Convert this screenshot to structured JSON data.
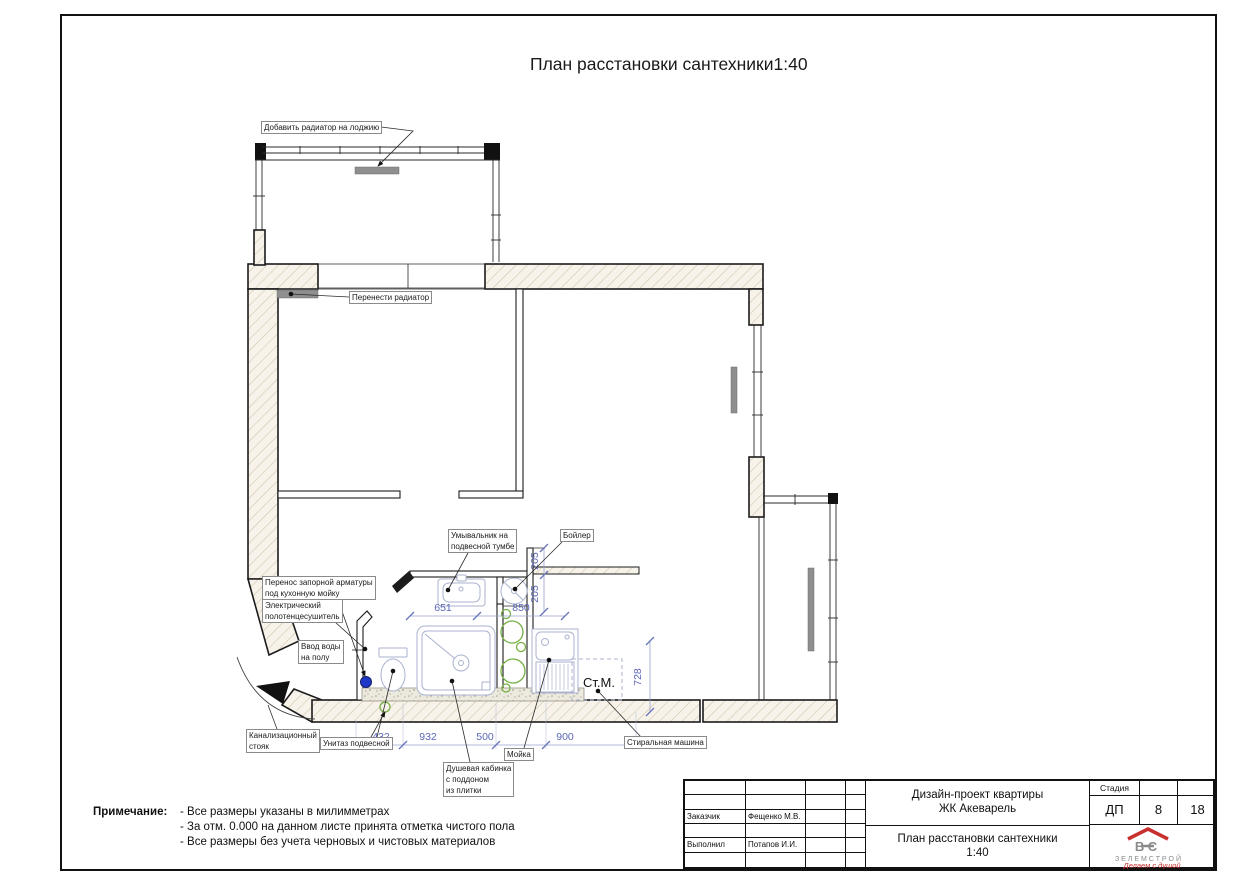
{
  "sheet": {
    "title": "План расстановки сантехники1:40"
  },
  "plan": {
    "callouts": {
      "add_radiator": "Добавить радиатор на лоджию",
      "move_radiator": "Перенести радиатор",
      "sink": "Умывальник на\nподвесной тумбе",
      "boiler": "Бойлер",
      "valve": "Перенос запорной арматуры\nпод кухонную мойку",
      "towel_dryer": "Электрический\nполотенцесушитель",
      "water_inlet": "Ввод воды\nна полу",
      "sewer_riser": "Канализационный\nстояк",
      "toilet": "Унитаз подвесной",
      "shower": "Душевая кабинка\nс поддоном\nиз плитки",
      "kitchen_sink": "Мойка",
      "washing_machine": "Стиральная машина"
    },
    "washing_machine_abbr": "Ст.М.",
    "dims": {
      "sink_width": "651",
      "niche_width": "850",
      "niche_depth_a": "205",
      "niche_depth_b": "205",
      "wm_depth": "728",
      "chain": [
        "432",
        "932",
        "500",
        "900"
      ]
    },
    "colors": {
      "dimension_text": "#5b67b8",
      "fixture_stroke": "#a9b2cf",
      "pipe_green": "#76b043",
      "water_inlet_blue": "#2038c8",
      "radiator_gray": "#8f8f8f"
    }
  },
  "notes": {
    "label": "Примечание:",
    "lines": [
      "- Все размеры указаны в милимметрах",
      "- За отм. 0.000 на данном листе принята отметка чистого пола",
      "-  Все размеры без учета черновых и чистовых материалов"
    ]
  },
  "titleblock": {
    "customer_label": "Заказчик",
    "customer_value": "Фещенко М.В.",
    "author_label": "Выполнил",
    "author_value": "Потапов И.И.",
    "project_line1": "Дизайн-проект квартиры",
    "project_line2": "ЖК Акеварель",
    "sheet_title_line1": "План расстановки сантехники",
    "sheet_title_line2": "1:40",
    "stage_label": "Стадия",
    "stage_value": "ДП",
    "sheet_number": "8",
    "total_sheets": "18",
    "logo": {
      "letters": "ВС",
      "company": "З Е Л Е М С Т Р О Й",
      "tagline": "Делаем с душой"
    }
  }
}
